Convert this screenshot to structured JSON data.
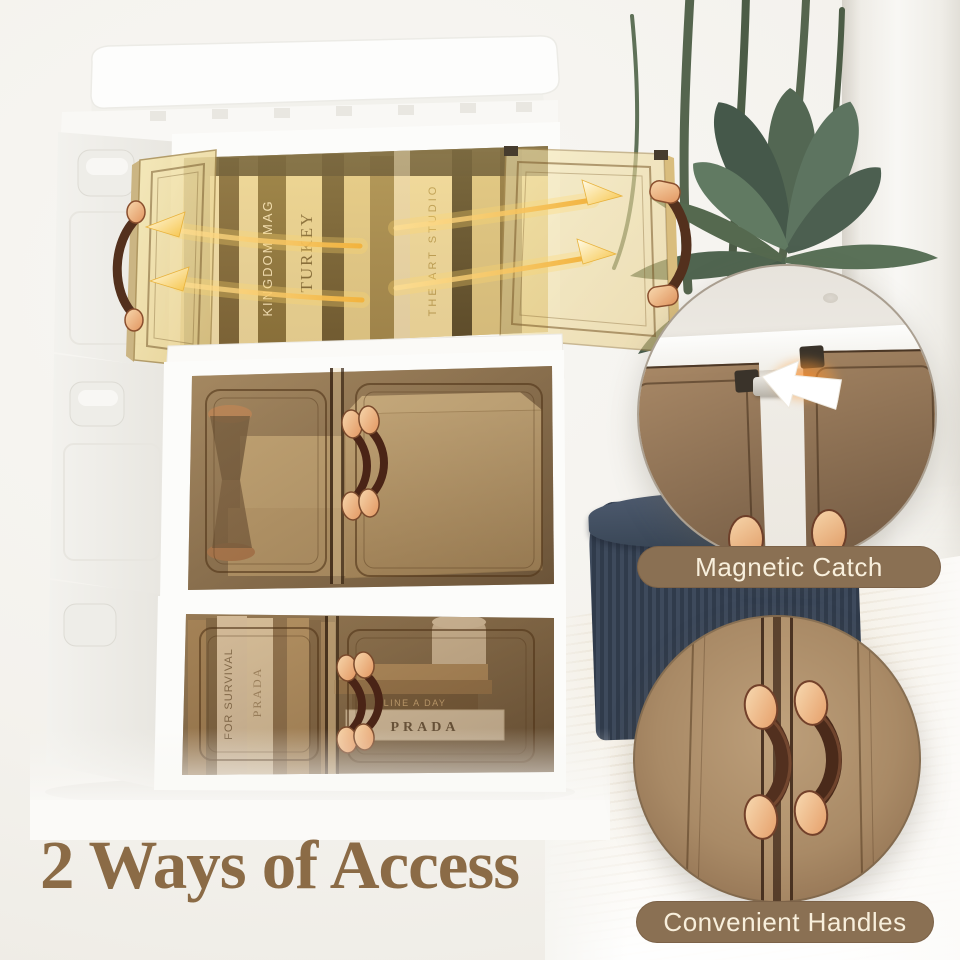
{
  "page": {
    "heading": "2 Ways of Access"
  },
  "callouts": {
    "magnet": {
      "label": "Magnetic Catch"
    },
    "handles": {
      "label": "Convenient Handles"
    }
  },
  "bins": {
    "top": {
      "books": [
        "KINGDOM MAG",
        "TURKEY",
        "THE ART STUDIO"
      ]
    },
    "bottom": {
      "spine_a": "FOR SURVIVAL",
      "spine_b": "PRADA",
      "book_label": "LINE A DAY",
      "box_label": "PRADA"
    }
  },
  "colors": {
    "heading_brown": "#8b6b46",
    "pill_background": "#8a7053",
    "pill_text": "#f8efdc",
    "glass_amber": "#a9885f",
    "handle_strap": "#4f2a1b",
    "rivet_copper": "#eeae7e",
    "arrow_gold": "#f4c04a",
    "ottoman_navy": "#39465a",
    "leaf_green": "#55694f"
  }
}
